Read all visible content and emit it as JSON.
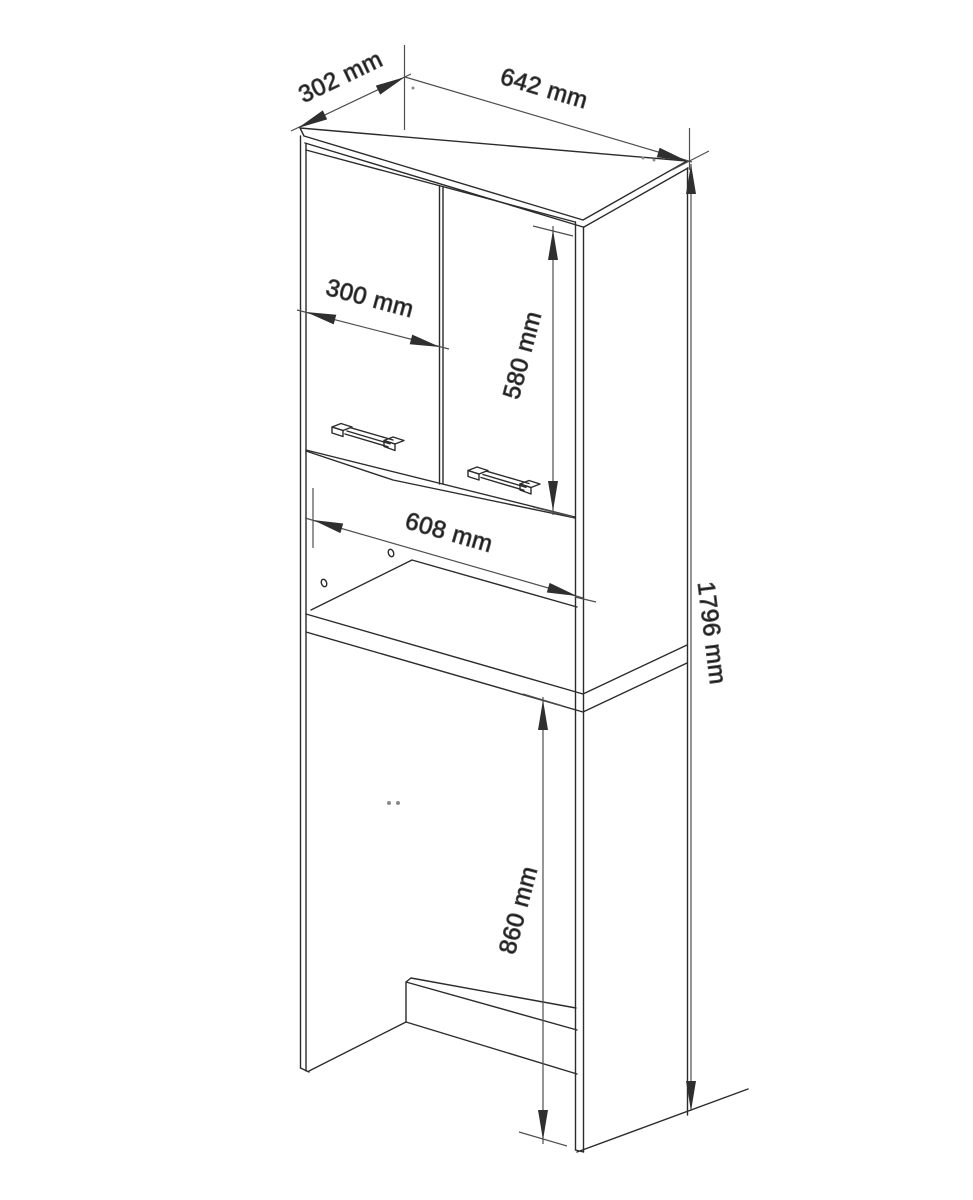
{
  "page": {
    "background": "#ffffff"
  },
  "drawing": {
    "type": "furniture-technical-drawing",
    "subject": "tall bathroom cabinet over washing machine",
    "colors": {
      "line": "#2b2b2b",
      "dimension": "#4f4f4f",
      "arrow": "#2f2f2f",
      "text": "#111111",
      "background": "#ffffff"
    },
    "dimensions": {
      "top_depth": {
        "label": "302 mm",
        "value_mm": 302
      },
      "top_width": {
        "label": "642 mm",
        "value_mm": 642
      },
      "door_width": {
        "label": "300 mm",
        "value_mm": 300
      },
      "door_height": {
        "label": "580 mm",
        "value_mm": 580
      },
      "niche_width": {
        "label": "608 mm",
        "value_mm": 608
      },
      "total_height": {
        "label": "1796 mm",
        "value_mm": 1796
      },
      "bottom_clearance": {
        "label": "860 mm",
        "value_mm": 860
      }
    }
  }
}
